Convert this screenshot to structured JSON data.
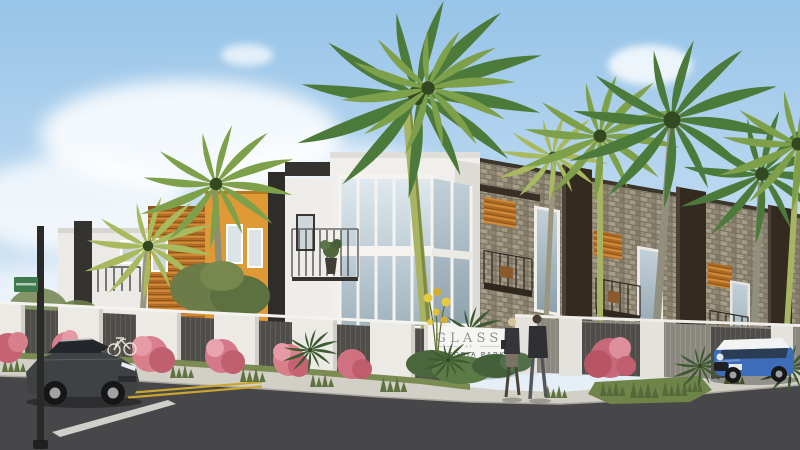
{
  "scene": {
    "title": "Modern townhome community exterior rendering at a street corner with palm trees",
    "monument_sign": {
      "line1": "GLASS",
      "line2": "AT",
      "line3": "VICTORIA PARK"
    },
    "palette": {
      "sky_top": "#96c4e8",
      "sky_horizon": "#eef4f9",
      "cloud_white": "#ffffff",
      "stucco_white": "#f1efeb",
      "wood_slat_orange": "#c07a2c",
      "accent_orange": "#e09a35",
      "charcoal_trim": "#332a20",
      "stone_veneer": "#9c937f",
      "glass_blue": "#c9d5dd",
      "fence_white": "#eceae5",
      "fence_panel_dark": "#4e4d49",
      "bougainvillea_pink": "#d97f8c",
      "palm_green": "#4c7a3a",
      "palm_yellow_green": "#a9b95e",
      "palm_trunk_lime": "#a9b463",
      "grass_green": "#7c8f55",
      "sidewalk_gray": "#d2cfc6",
      "road_asphalt": "#47474a",
      "center_line_yellow": "#c9a62e",
      "sedan_dark_gray": "#3f4244",
      "mini_blue": "#3d6db8",
      "mini_roof_white": "#f2f3f2",
      "street_sign_green": "#3f7a4e"
    }
  }
}
